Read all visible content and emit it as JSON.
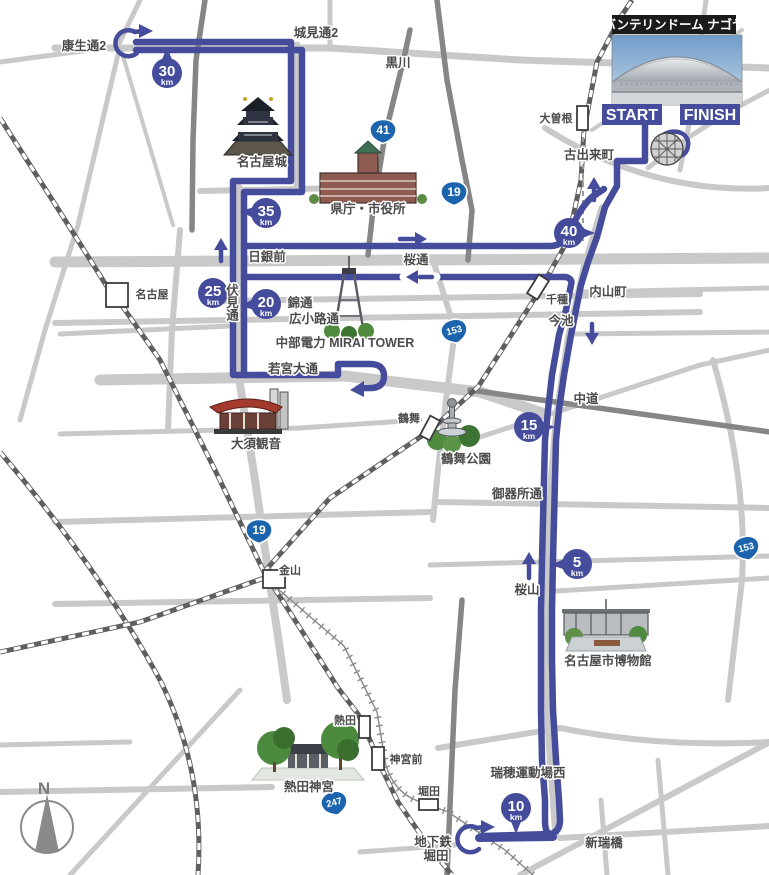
{
  "map": {
    "dome_label": "バンテリンドーム ナゴヤ",
    "start": "START",
    "finish": "FINISH",
    "compass_n": "N",
    "km_unit": "km"
  },
  "km_markers": {
    "k5": "5",
    "k10": "10",
    "k15": "15",
    "k20": "20",
    "k25": "25",
    "k30": "30",
    "k35": "35",
    "k40": "40"
  },
  "shields": {
    "r41": "41",
    "r19": "19",
    "r153": "153",
    "r247": "247"
  },
  "labels": {
    "koseidori2": "康生通2",
    "shiromidori2": "城見通2",
    "kurokawa": "黒川",
    "ozone": "大曽根",
    "furudekicho": "古出来町",
    "nagoyajo": "名古屋城",
    "kencho": "県庁・市役所",
    "nichiginmae": "日銀前",
    "sakuradori": "桜通",
    "nishikidori": "錦通",
    "hirokojidori": "広小路通",
    "fushimidori": "伏見通",
    "miraitower": "中部電力 MIRAI TOWER",
    "wakamiyaodori": "若宮大通",
    "nagoya_sta": "名古屋",
    "uchiyamacho": "内山町",
    "chikusa": "千種",
    "imaike": "今池",
    "nakamichi": "中道",
    "tsurumai": "鶴舞",
    "tsurumakoen": "鶴舞公園",
    "osukannon": "大須観音",
    "gokishodori": "御器所通",
    "sakurayama": "桜山",
    "hakubutsukan": "名古屋市博物館",
    "kanayama": "金山",
    "atsuta": "熱田",
    "jingumae": "神宮前",
    "horita": "堀田",
    "chikatetsu": "地下鉄",
    "chikatetsu_horita": "堀田",
    "mizuho": "瑞穂運動場西",
    "aratamabashi": "新瑞橋",
    "atsutajingu": "熱田神宮"
  },
  "colors": {
    "route_blue": "#454c9b",
    "shield_blue": "#1c64ad",
    "badge_blue": "#454c9b",
    "road_light": "#c9c9c9",
    "road_dark": "#868686",
    "text": "#4b4b4b",
    "rail_dark": "#5f5f5f",
    "dome_label_bg": "#1b1b1b"
  }
}
